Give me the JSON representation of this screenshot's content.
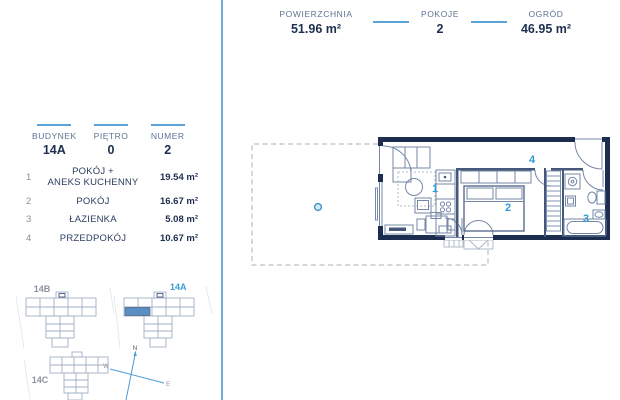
{
  "colors": {
    "accent_blue": "#2f9ad2",
    "navy_text": "#1d2e4e",
    "slate_label": "#5d7292",
    "divider_blue": "#5ba3d6",
    "wall_navy": "#1d2d4f",
    "plan_line": "#7487a6",
    "muted_gray": "#8a919c",
    "highlight_unit_fill": "#5b8fc4"
  },
  "top_stats": {
    "items": [
      {
        "label": "POWIERZCHNIA",
        "value": "51.96 m²"
      },
      {
        "label": "POKOJE",
        "value": "2"
      },
      {
        "label": "OGRÓD",
        "value": "46.95 m²"
      }
    ]
  },
  "unit_info": {
    "items": [
      {
        "label": "BUDYNEK",
        "value": "14A"
      },
      {
        "label": "PIĘTRO",
        "value": "0"
      },
      {
        "label": "NUMER",
        "value": "2"
      }
    ]
  },
  "room_list": {
    "rows": [
      {
        "no": "1",
        "name_line1": "POKÓJ +",
        "name_line2": "ANEKS KUCHENNY",
        "area": "19.54 m²"
      },
      {
        "no": "2",
        "name_line1": "POKÓJ",
        "name_line2": "",
        "area": "16.67 m²"
      },
      {
        "no": "3",
        "name_line1": "ŁAZIENKA",
        "name_line2": "",
        "area": "5.08 m²"
      },
      {
        "no": "4",
        "name_line1": "PRZEDPOKÓJ",
        "name_line2": "",
        "area": "10.67 m²"
      }
    ]
  },
  "floor_plan": {
    "labels": {
      "room1": "1",
      "room2": "2",
      "room3": "3",
      "room4": "4"
    }
  },
  "site_plans": {
    "building_b": "14B",
    "building_a": "14A",
    "building_c": "14C"
  },
  "compass": {
    "north": "N",
    "west": "W",
    "east": "E"
  }
}
